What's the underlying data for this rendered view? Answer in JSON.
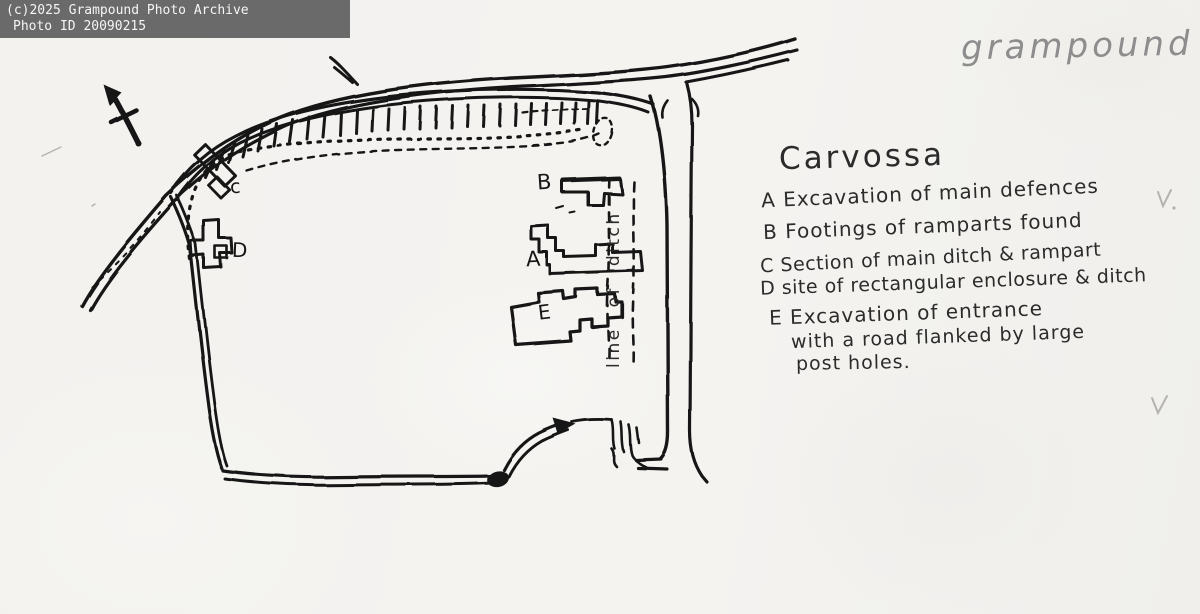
{
  "banner": {
    "line1": "(c)2025 Grampound Photo Archive",
    "line2": "Photo ID 20090215"
  },
  "page_title": "grampound",
  "legend": {
    "title": "Carvossa",
    "entry_a": "A Excavation of main defences",
    "entry_b": "B Footings of ramparts found",
    "entry_c": "C Section of main ditch & rampart",
    "entry_d": "D site of rectangular enclosure & ditch",
    "entry_e_line1": "E Excavation of entrance",
    "entry_e_line2": "with a road flanked by large",
    "entry_e_line3": "post holes."
  },
  "map": {
    "label_a": "A",
    "label_b": "B",
    "label_c": "c",
    "label_d": "D",
    "label_e": "E",
    "ditch_line_label": "line of ditch"
  },
  "colors": {
    "ink": "#191919",
    "pencil": "#8d8d8d",
    "paper": "#f3f2ef",
    "banner_bg": "#6a6a6a",
    "banner_text": "#f5f5f5"
  }
}
